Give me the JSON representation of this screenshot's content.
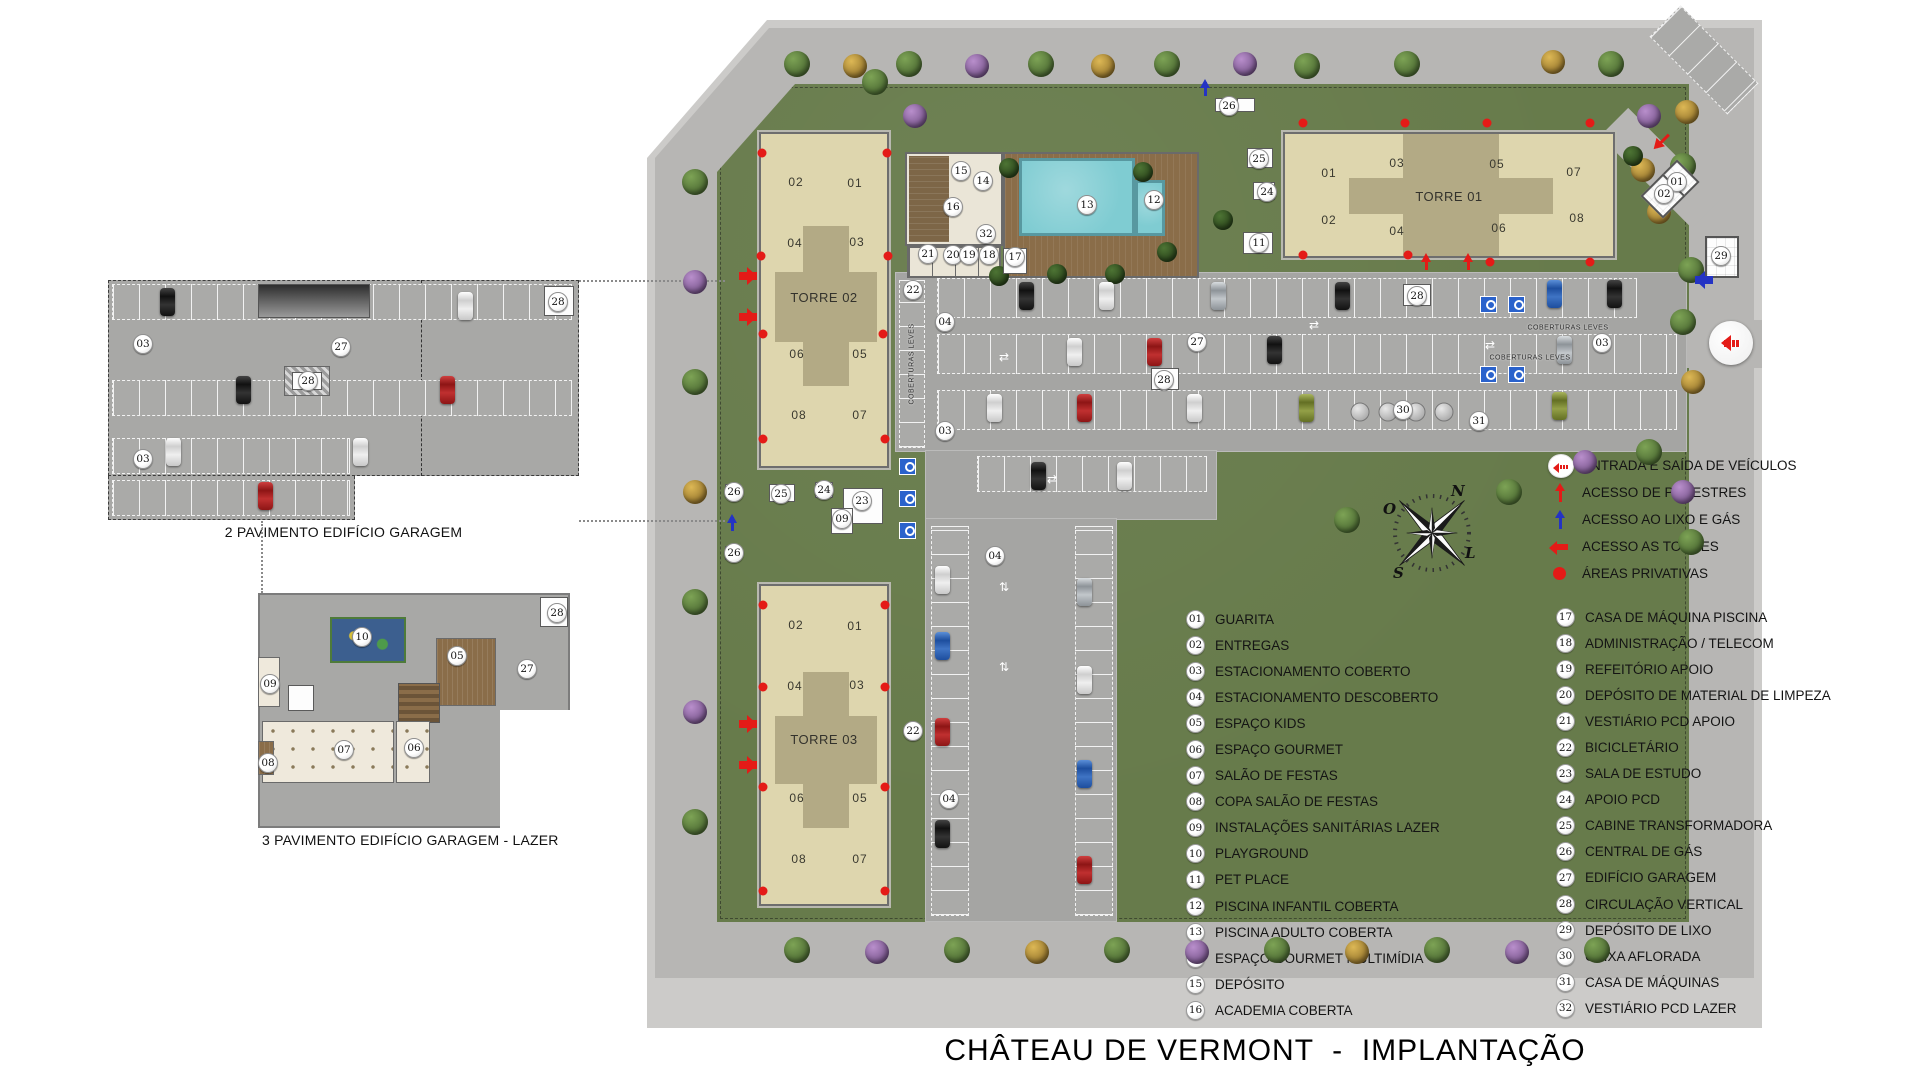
{
  "title": "CHÂTEAU DE VERMONT  -  IMPLANTAÇÃO",
  "plans": {
    "garage2": {
      "label": "2 PAVIMENTO EDIFÍCIO GARAGEM",
      "badges": [
        {
          "n": "03",
          "x": 35,
          "y": 64
        },
        {
          "n": "27",
          "x": 233,
          "y": 67
        },
        {
          "n": "28",
          "x": 200,
          "y": 101
        },
        {
          "n": "03",
          "x": 35,
          "y": 179
        },
        {
          "n": "28",
          "x": 450,
          "y": 22
        }
      ]
    },
    "garage3": {
      "label": "3 PAVIMENTO EDIFÍCIO GARAGEM - LAZER",
      "badges": [
        {
          "n": "10",
          "x": 104,
          "y": 44
        },
        {
          "n": "05",
          "x": 199,
          "y": 63
        },
        {
          "n": "09",
          "x": 12,
          "y": 91
        },
        {
          "n": "07",
          "x": 86,
          "y": 157
        },
        {
          "n": "06",
          "x": 156,
          "y": 155
        },
        {
          "n": "08",
          "x": 10,
          "y": 170
        },
        {
          "n": "27",
          "x": 269,
          "y": 76
        },
        {
          "n": "28",
          "x": 299,
          "y": 20
        }
      ]
    }
  },
  "towers": {
    "t1": {
      "name": "TORRE 01",
      "units": [
        {
          "n": "01",
          "x": 44,
          "y": 39
        },
        {
          "n": "03",
          "x": 112,
          "y": 29
        },
        {
          "n": "05",
          "x": 212,
          "y": 30
        },
        {
          "n": "07",
          "x": 289,
          "y": 38
        },
        {
          "n": "02",
          "x": 44,
          "y": 86
        },
        {
          "n": "04",
          "x": 112,
          "y": 97
        },
        {
          "n": "06",
          "x": 214,
          "y": 94
        },
        {
          "n": "08",
          "x": 292,
          "y": 84
        }
      ]
    },
    "t2": {
      "name": "TORRE 02",
      "units": [
        {
          "n": "02",
          "x": 35,
          "y": 48
        },
        {
          "n": "01",
          "x": 94,
          "y": 49
        },
        {
          "n": "04",
          "x": 34,
          "y": 109
        },
        {
          "n": "03",
          "x": 96,
          "y": 108
        },
        {
          "n": "06",
          "x": 36,
          "y": 220
        },
        {
          "n": "05",
          "x": 99,
          "y": 220
        },
        {
          "n": "08",
          "x": 38,
          "y": 281
        },
        {
          "n": "07",
          "x": 99,
          "y": 281
        }
      ]
    },
    "t3": {
      "name": "TORRE 03",
      "units": [
        {
          "n": "02",
          "x": 35,
          "y": 39
        },
        {
          "n": "01",
          "x": 94,
          "y": 40
        },
        {
          "n": "04",
          "x": 34,
          "y": 100
        },
        {
          "n": "03",
          "x": 96,
          "y": 99
        },
        {
          "n": "06",
          "x": 36,
          "y": 212
        },
        {
          "n": "05",
          "x": 99,
          "y": 212
        },
        {
          "n": "08",
          "x": 38,
          "y": 273
        },
        {
          "n": "07",
          "x": 99,
          "y": 273
        }
      ]
    }
  },
  "siteplan": {
    "coberturas_label": "COBERTURAS LEVES",
    "badges": [
      {
        "n": "26",
        "x": 582,
        "y": 86
      },
      {
        "n": "25",
        "x": 612,
        "y": 139
      },
      {
        "n": "24",
        "x": 620,
        "y": 172
      },
      {
        "n": "11",
        "x": 612,
        "y": 223
      },
      {
        "n": "15",
        "x": 314,
        "y": 151
      },
      {
        "n": "14",
        "x": 336,
        "y": 161
      },
      {
        "n": "16",
        "x": 306,
        "y": 187
      },
      {
        "n": "32",
        "x": 339,
        "y": 214
      },
      {
        "n": "13",
        "x": 440,
        "y": 185
      },
      {
        "n": "12",
        "x": 507,
        "y": 180
      },
      {
        "n": "21",
        "x": 281,
        "y": 234
      },
      {
        "n": "20",
        "x": 306,
        "y": 235
      },
      {
        "n": "19",
        "x": 322,
        "y": 235
      },
      {
        "n": "18",
        "x": 342,
        "y": 235
      },
      {
        "n": "17",
        "x": 368,
        "y": 237
      },
      {
        "n": "22",
        "x": 266,
        "y": 270
      },
      {
        "n": "04",
        "x": 298,
        "y": 302
      },
      {
        "n": "27",
        "x": 550,
        "y": 322
      },
      {
        "n": "28",
        "x": 517,
        "y": 360
      },
      {
        "n": "28",
        "x": 770,
        "y": 276
      },
      {
        "n": "03",
        "x": 298,
        "y": 411
      },
      {
        "n": "03",
        "x": 955,
        "y": 323
      },
      {
        "n": "30",
        "x": 756,
        "y": 390
      },
      {
        "n": "31",
        "x": 832,
        "y": 401
      },
      {
        "n": "25",
        "x": 134,
        "y": 474
      },
      {
        "n": "24",
        "x": 177,
        "y": 470
      },
      {
        "n": "23",
        "x": 215,
        "y": 481
      },
      {
        "n": "09",
        "x": 195,
        "y": 499
      },
      {
        "n": "26",
        "x": 87,
        "y": 472
      },
      {
        "n": "26",
        "x": 87,
        "y": 533
      },
      {
        "n": "04",
        "x": 348,
        "y": 536
      },
      {
        "n": "22",
        "x": 266,
        "y": 711
      },
      {
        "n": "04",
        "x": 302,
        "y": 779
      },
      {
        "n": "01",
        "x": 1030,
        "y": 162
      },
      {
        "n": "02",
        "x": 1017,
        "y": 174
      },
      {
        "n": "29",
        "x": 1074,
        "y": 236
      }
    ]
  },
  "symbol_legend": [
    {
      "icon": "ic-entry",
      "label": "ENTRADA E SAÍDA DE VEÍCULOS"
    },
    {
      "icon": "ic-ped",
      "label": "ACESSO DE PEDESTRES"
    },
    {
      "icon": "ic-gas",
      "label": "ACESSO AO LIXO E GÁS"
    },
    {
      "icon": "ic-towers",
      "label": "ACESSO AS TORRES"
    },
    {
      "icon": "ic-priv",
      "label": "ÁREAS PRIVATIVAS"
    }
  ],
  "legend_col1": [
    {
      "n": "01",
      "label": "GUARITA"
    },
    {
      "n": "02",
      "label": "ENTREGAS"
    },
    {
      "n": "03",
      "label": "ESTACIONAMENTO COBERTO"
    },
    {
      "n": "04",
      "label": "ESTACIONAMENTO DESCOBERTO"
    },
    {
      "n": "05",
      "label": "ESPAÇO KIDS"
    },
    {
      "n": "06",
      "label": "ESPAÇO GOURMET"
    },
    {
      "n": "07",
      "label": "SALÃO DE FESTAS"
    },
    {
      "n": "08",
      "label": "COPA SALÃO DE FESTAS"
    },
    {
      "n": "09",
      "label": "INSTALAÇÕES SANITÁRIAS LAZER"
    },
    {
      "n": "10",
      "label": "PLAYGROUND"
    },
    {
      "n": "11",
      "label": "PET PLACE"
    },
    {
      "n": "12",
      "label": "PISCINA INFANTIL COBERTA"
    },
    {
      "n": "13",
      "label": "PISCINA ADULTO COBERTA"
    },
    {
      "n": "14",
      "label": "ESPAÇO GOURMET MULTIMÍDIA"
    },
    {
      "n": "15",
      "label": "DEPÓSITO"
    },
    {
      "n": "16",
      "label": "ACADEMIA COBERTA"
    }
  ],
  "legend_col2": [
    {
      "n": "17",
      "label": "CASA DE MÁQUINA PISCINA"
    },
    {
      "n": "18",
      "label": "ADMINISTRAÇÃO / TELECOM"
    },
    {
      "n": "19",
      "label": "REFEITÓRIO APOIO"
    },
    {
      "n": "20",
      "label": "DEPÓSITO DE MATERIAL DE LIMPEZA"
    },
    {
      "n": "21",
      "label": "VESTIÁRIO PCD APOIO"
    },
    {
      "n": "22",
      "label": "BICICLETÁRIO"
    },
    {
      "n": "23",
      "label": "SALA DE ESTUDO"
    },
    {
      "n": "24",
      "label": "APOIO PCD"
    },
    {
      "n": "25",
      "label": "CABINE TRANSFORMADORA"
    },
    {
      "n": "26",
      "label": "CENTRAL DE GÁS"
    },
    {
      "n": "27",
      "label": "EDIFÍCIO GARAGEM"
    },
    {
      "n": "28",
      "label": "CIRCULAÇÃO VERTICAL"
    },
    {
      "n": "29",
      "label": "DEPÓSITO DE LIXO"
    },
    {
      "n": "30",
      "label": "CAIXA AFLORADA"
    },
    {
      "n": "31",
      "label": "CASA DE MÁQUINAS"
    },
    {
      "n": "32",
      "label": "VESTIÁRIO PCD LAZER"
    }
  ],
  "compass": {
    "n": "N",
    "s": "S",
    "e": "L",
    "w": "O"
  }
}
